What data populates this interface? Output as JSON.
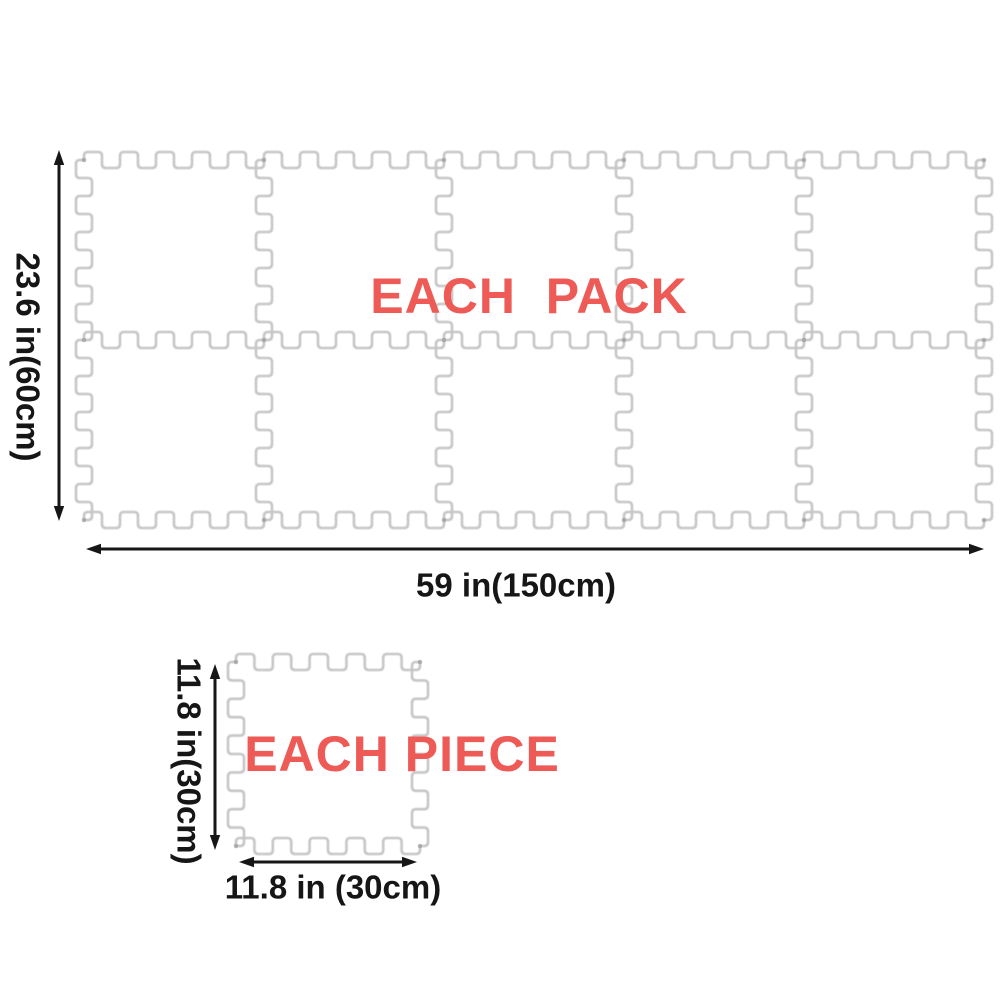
{
  "diagram": {
    "pack": {
      "title": "EACH  PACK",
      "height_label": "23.6 in(60cm)",
      "width_label": "59 in(150cm)",
      "tile_columns": 5,
      "tile_rows": 2
    },
    "piece": {
      "title": "EACH PIECE",
      "height_label": "11.8 in(30cm)",
      "width_label": "11.8 in (30cm)"
    },
    "colors": {
      "accent_red": "#ee5a56",
      "mat_outline": "#c6c6c6",
      "dimension_ink": "#161616"
    }
  }
}
